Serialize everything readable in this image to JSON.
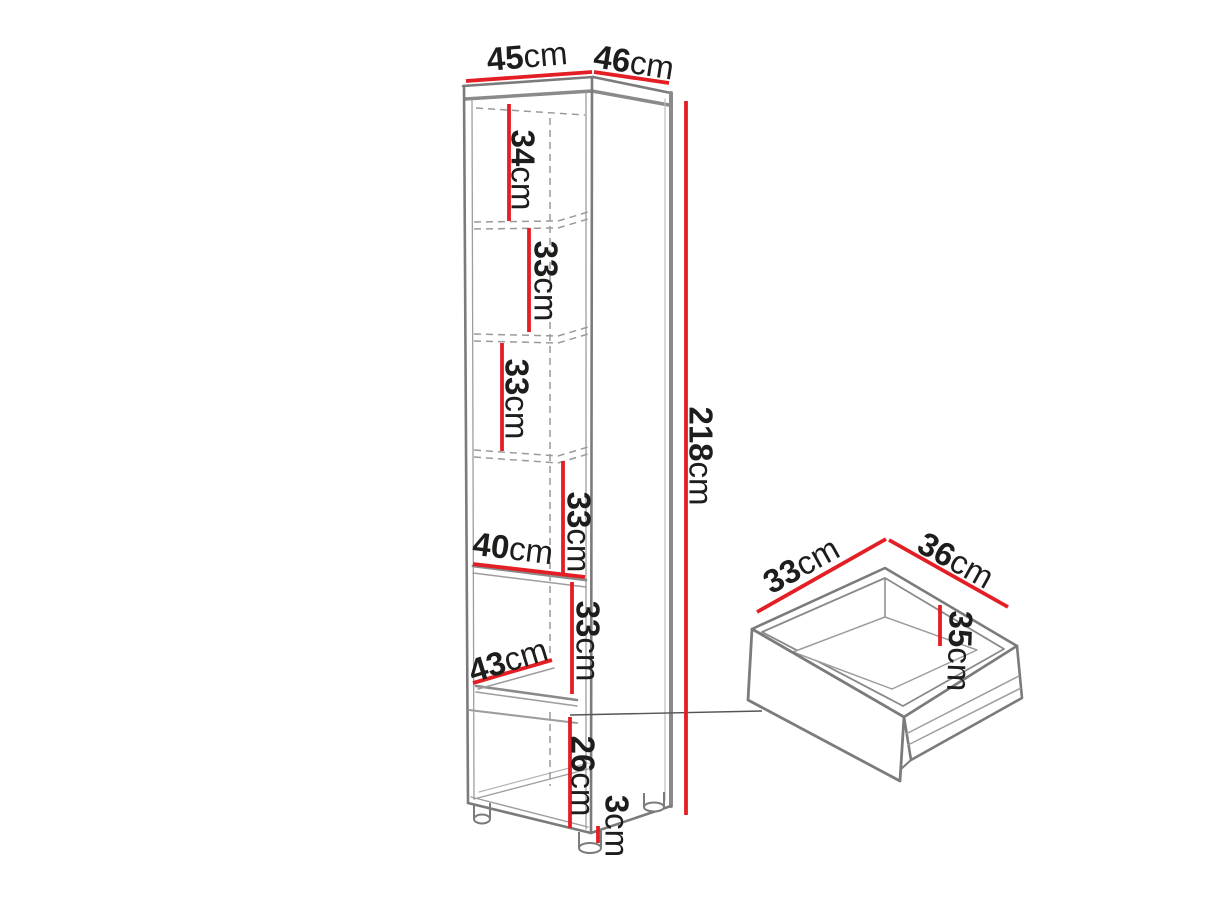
{
  "page": {
    "background": "#ffffff"
  },
  "colors": {
    "dimension_red": "#e31e24",
    "outline_gray": "#7b7b7b",
    "outline_light": "#9d9d9d",
    "text": "#1d1d1b"
  },
  "cabinet": {
    "name": "tall cabinet with shelves",
    "dimensions": [
      {
        "id": "top-width",
        "num": "45",
        "unit": "cm"
      },
      {
        "id": "top-depth",
        "num": "46",
        "unit": "cm"
      },
      {
        "id": "section-1",
        "num": "34",
        "unit": "cm"
      },
      {
        "id": "section-2",
        "num": "33",
        "unit": "cm"
      },
      {
        "id": "section-3",
        "num": "33",
        "unit": "cm"
      },
      {
        "id": "total-height",
        "num": "218",
        "unit": "cm"
      },
      {
        "id": "section-4",
        "num": "33",
        "unit": "cm"
      },
      {
        "id": "shelf-width",
        "num": "40",
        "unit": "cm"
      },
      {
        "id": "section-5",
        "num": "33",
        "unit": "cm"
      },
      {
        "id": "interior-depth",
        "num": "43",
        "unit": "cm"
      },
      {
        "id": "section-6",
        "num": "26",
        "unit": "cm"
      },
      {
        "id": "feet-height",
        "num": "3",
        "unit": "cm"
      }
    ]
  },
  "drawer": {
    "name": "drawer box",
    "dimensions": [
      {
        "id": "drawer-width",
        "num": "33",
        "unit": "cm"
      },
      {
        "id": "drawer-depth",
        "num": "36",
        "unit": "cm"
      },
      {
        "id": "drawer-height",
        "num": "35",
        "unit": "cm"
      }
    ]
  }
}
